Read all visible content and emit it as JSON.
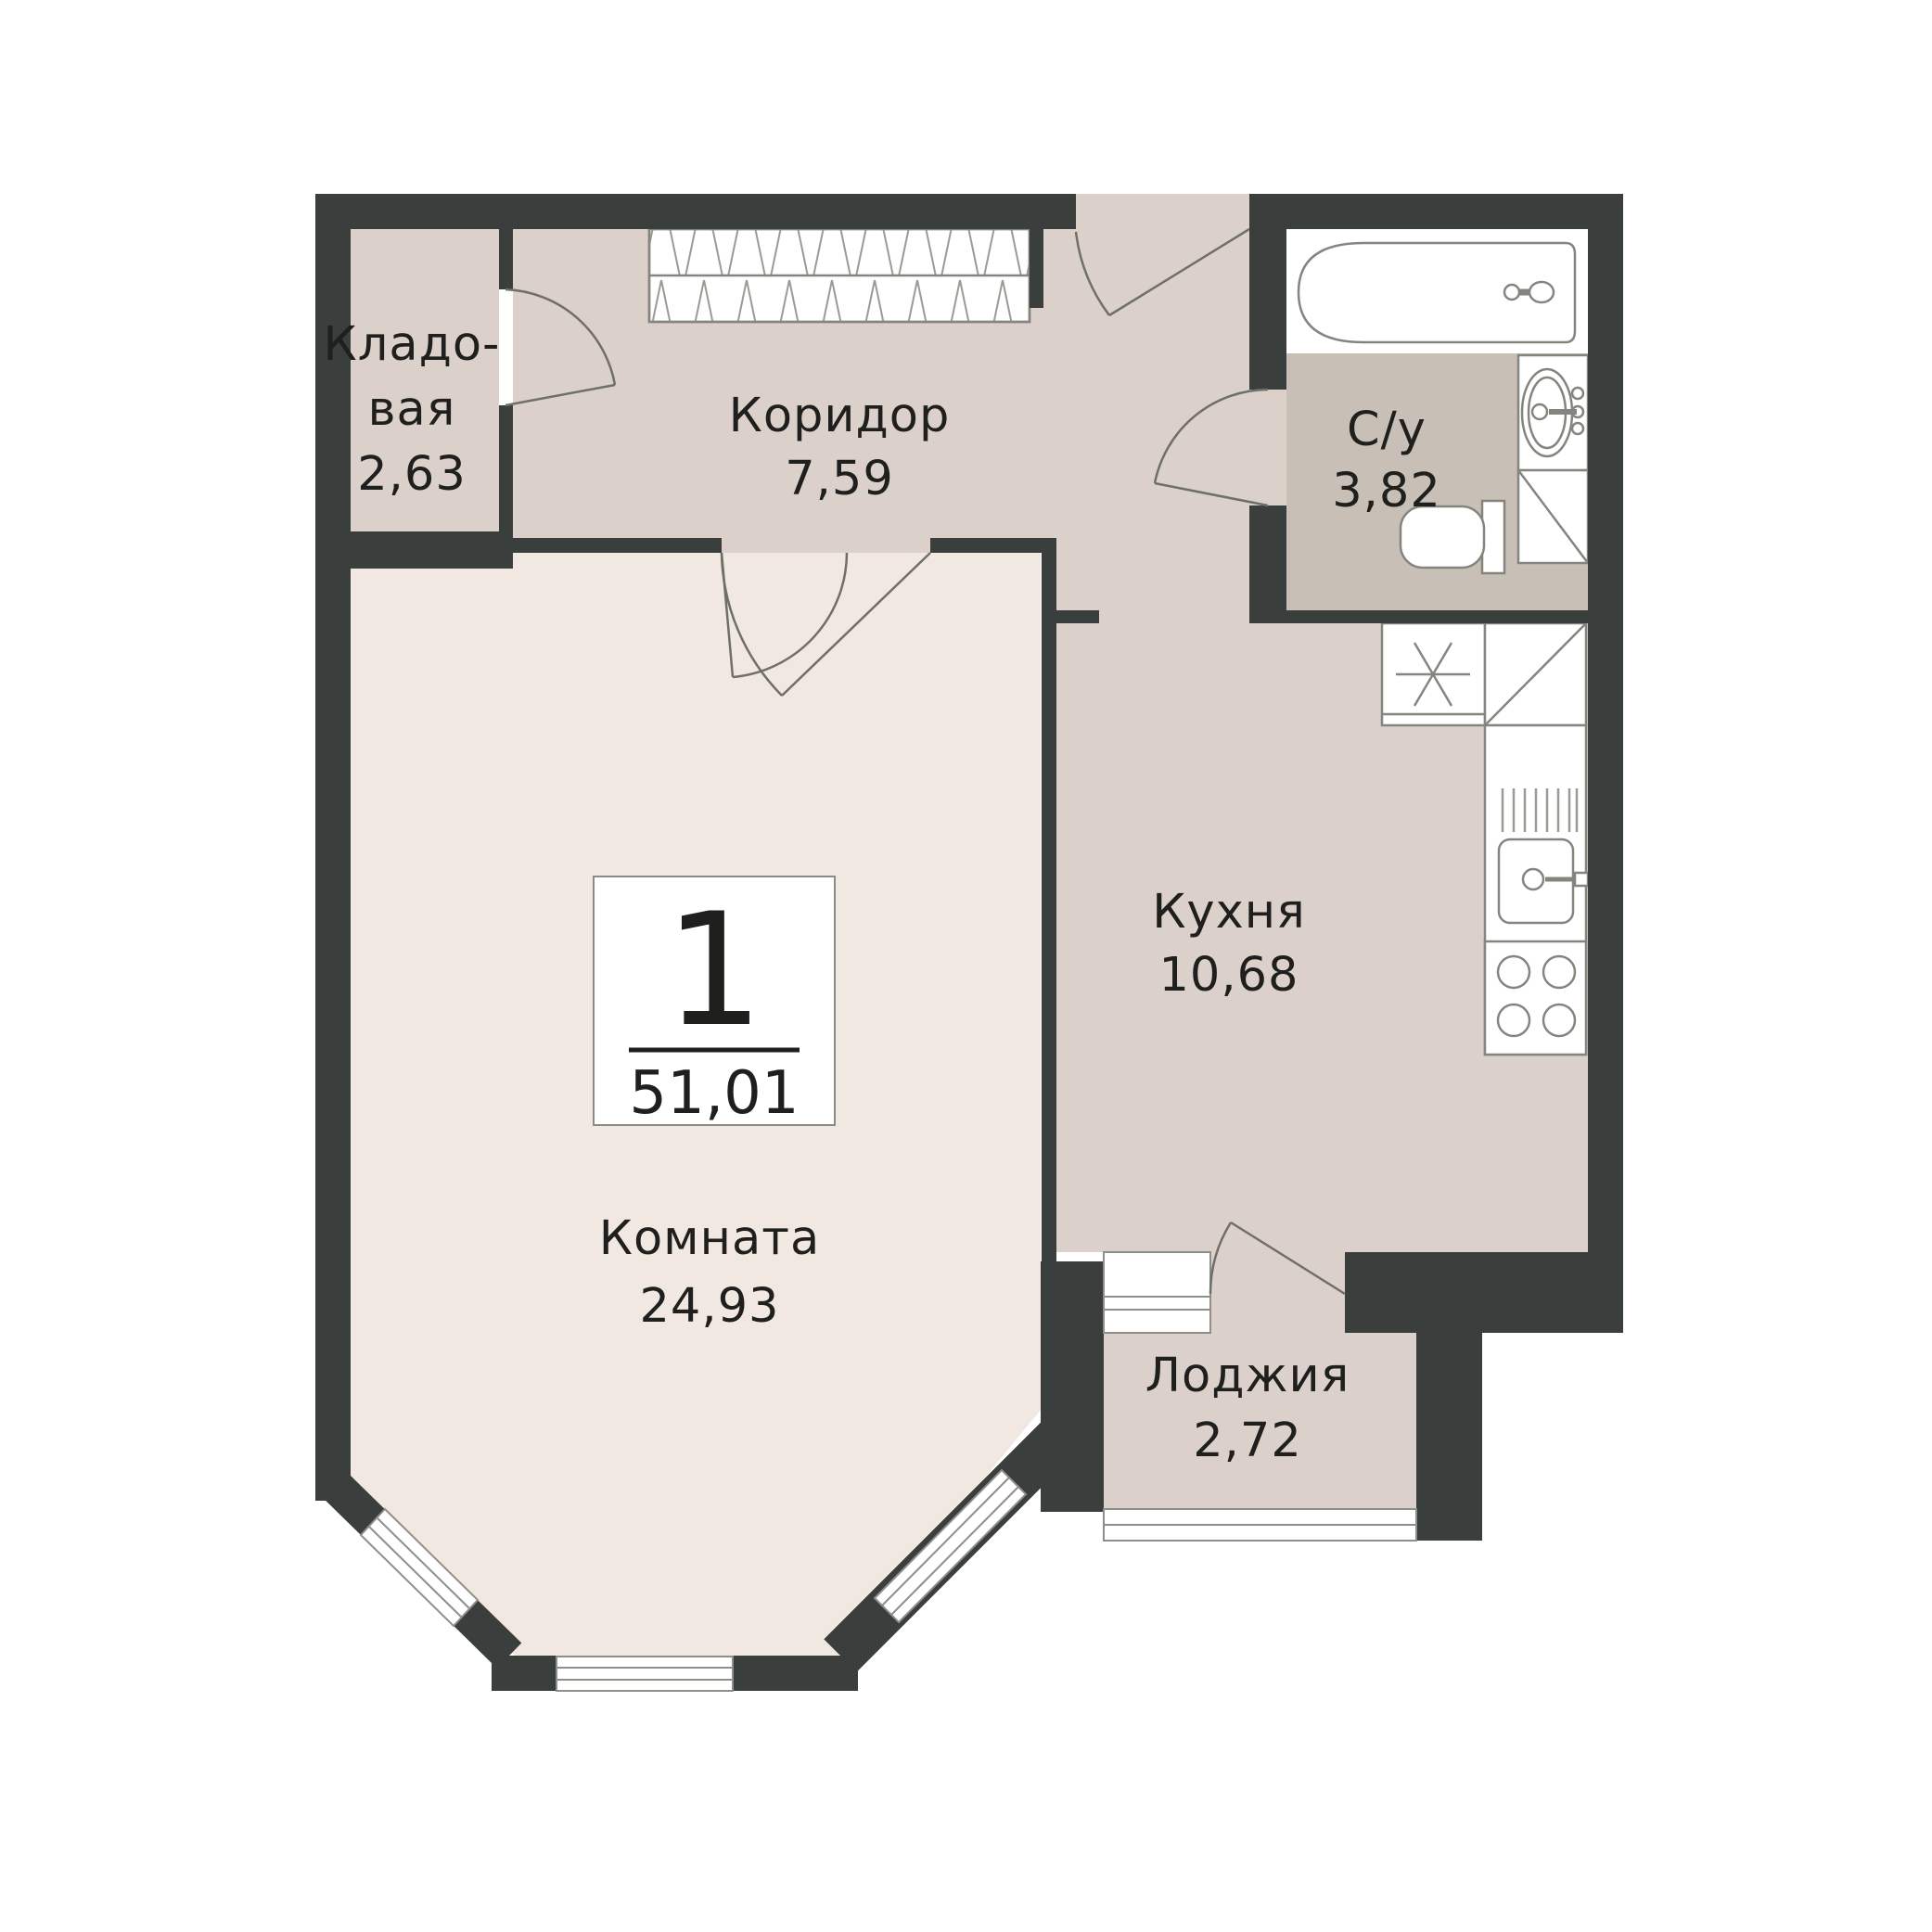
{
  "plan": {
    "type": "apartment-floor-plan",
    "badge": {
      "number": "1",
      "total_area": "51,01"
    },
    "rooms": [
      {
        "id": "storage",
        "name": "Кладовая",
        "name_line1": "Кладо-",
        "name_line2": "вая",
        "area": "2,63"
      },
      {
        "id": "corridor",
        "name": "Коридор",
        "area": "7,59"
      },
      {
        "id": "bathroom",
        "name": "С/у",
        "area": "3,82"
      },
      {
        "id": "kitchen",
        "name": "Кухня",
        "area": "10,68"
      },
      {
        "id": "living",
        "name": "Комната",
        "area": "24,93"
      },
      {
        "id": "loggia",
        "name": "Лоджия",
        "area": "2,72"
      }
    ],
    "fixtures": [
      "wardrobe",
      "entrance-door",
      "storage-door",
      "living-double-door",
      "bathtub",
      "washbasin",
      "toilet",
      "water-heater",
      "washing-machine",
      "fridge",
      "kitchen-counter",
      "kitchen-sink",
      "stove",
      "balcony-door",
      "loggia-glazing",
      "bay-windows"
    ],
    "palette": {
      "wall": "#3a3e3c",
      "floor_living": "#f1e8e2",
      "floor_hall": "#dbd1ca",
      "floor_bathroom": "#c8bfb7",
      "fixture_line": "#85857f",
      "window_line": "#8f8f8a",
      "text": "#1f1f1d",
      "background": "#ffffff"
    }
  }
}
